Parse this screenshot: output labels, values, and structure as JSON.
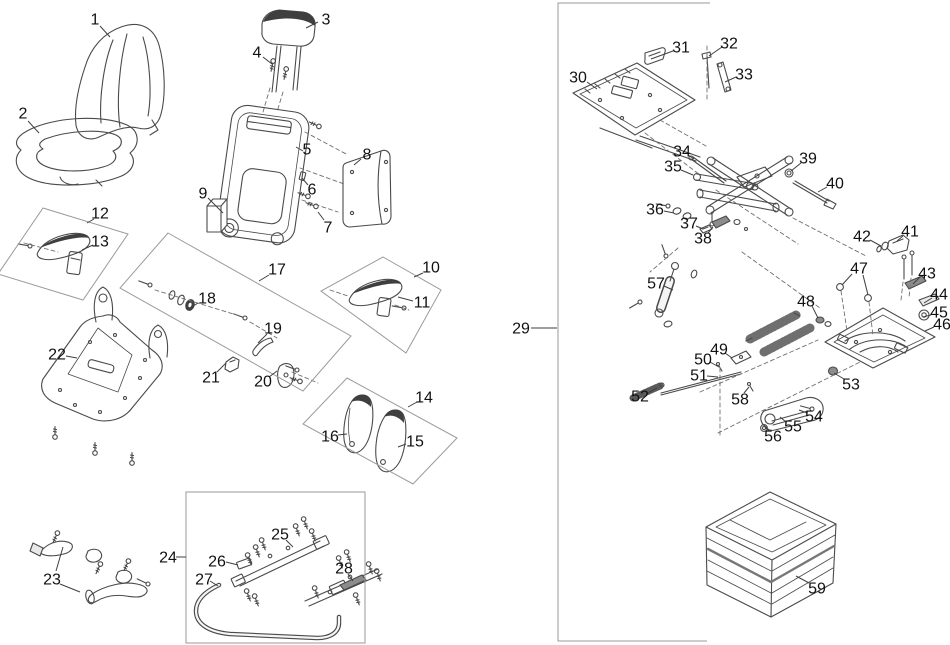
{
  "diagram": {
    "type": "exploded-parts-diagram",
    "subject": "operator seat assembly with suspension",
    "background": "#ffffff",
    "line_color": "#4a4a4a",
    "box_color": "#9a9a9a",
    "label_color": "#111111",
    "labels": [
      {
        "n": "1",
        "x": 95,
        "y": 19,
        "leaders": [
          [
            100,
            26,
            110,
            37
          ]
        ]
      },
      {
        "n": "2",
        "x": 23,
        "y": 113,
        "leaders": [
          [
            28,
            121,
            39,
            133
          ]
        ]
      },
      {
        "n": "3",
        "x": 326,
        "y": 19,
        "leaders": [
          [
            318,
            22,
            306,
            28
          ]
        ]
      },
      {
        "n": "4",
        "x": 257,
        "y": 52,
        "leaders": [
          [
            263,
            57,
            272,
            64
          ]
        ]
      },
      {
        "n": "5",
        "x": 307,
        "y": 149,
        "leaders": [
          [
            303,
            151,
            296,
            147
          ]
        ]
      },
      {
        "n": "6",
        "x": 312,
        "y": 189,
        "leaders": [
          [
            308,
            185,
            302,
            178
          ]
        ]
      },
      {
        "n": "7",
        "x": 328,
        "y": 227,
        "leaders": [
          [
            324,
            220,
            318,
            212
          ]
        ]
      },
      {
        "n": "8",
        "x": 367,
        "y": 154,
        "leaders": [
          [
            361,
            159,
            354,
            165
          ]
        ]
      },
      {
        "n": "9",
        "x": 203,
        "y": 193,
        "leaders": [
          [
            208,
            198,
            223,
            213
          ]
        ]
      },
      {
        "n": "10",
        "x": 431,
        "y": 267,
        "leaders": [
          [
            423,
            273,
            414,
            277
          ]
        ]
      },
      {
        "n": "11",
        "x": 422,
        "y": 302,
        "leaders": [
          [
            413,
            301,
            398,
            297
          ]
        ]
      },
      {
        "n": "12",
        "x": 100,
        "y": 213,
        "leaders": [
          [
            94,
            219,
            87,
            223
          ]
        ]
      },
      {
        "n": "13",
        "x": 100,
        "y": 241,
        "leaders": [
          [
            93,
            245,
            82,
            250
          ]
        ]
      },
      {
        "n": "14",
        "x": 424,
        "y": 397,
        "leaders": [
          [
            417,
            402,
            408,
            407
          ]
        ]
      },
      {
        "n": "15",
        "x": 415,
        "y": 441,
        "leaders": [
          [
            406,
            444,
            398,
            447
          ]
        ]
      },
      {
        "n": "16",
        "x": 330,
        "y": 436,
        "leaders": [
          [
            338,
            435,
            347,
            434
          ]
        ]
      },
      {
        "n": "17",
        "x": 277,
        "y": 269,
        "leaders": [
          [
            269,
            275,
            259,
            281
          ]
        ]
      },
      {
        "n": "18",
        "x": 207,
        "y": 298,
        "leaders": [
          [
            198,
            303,
            190,
            308
          ]
        ]
      },
      {
        "n": "19",
        "x": 273,
        "y": 328,
        "leaders": [
          [
            267,
            334,
            258,
            343
          ]
        ]
      },
      {
        "n": "20",
        "x": 263,
        "y": 381,
        "leaders": [
          [
            269,
            377,
            277,
            371
          ]
        ]
      },
      {
        "n": "21",
        "x": 211,
        "y": 377,
        "leaders": [
          [
            217,
            372,
            226,
            363
          ]
        ]
      },
      {
        "n": "22",
        "x": 57,
        "y": 354,
        "leaders": [
          [
            66,
            356,
            77,
            358
          ]
        ]
      },
      {
        "n": "23",
        "x": 52,
        "y": 579,
        "leaders": [
          [
            56,
            571,
            63,
            547
          ],
          [
            60,
            584,
            80,
            592
          ]
        ]
      },
      {
        "n": "24",
        "x": 168,
        "y": 557,
        "leaders": [
          [
            176,
            557,
            186,
            557
          ]
        ]
      },
      {
        "n": "25",
        "x": 280,
        "y": 534,
        "leaders": [
          [
            286,
            540,
            293,
            547
          ]
        ]
      },
      {
        "n": "26",
        "x": 217,
        "y": 561,
        "leaders": [
          [
            226,
            562,
            238,
            565
          ]
        ]
      },
      {
        "n": "27",
        "x": 204,
        "y": 579,
        "leaders": [
          [
            210,
            581,
            218,
            586
          ]
        ]
      },
      {
        "n": "28",
        "x": 344,
        "y": 568,
        "leaders": [
          [
            348,
            574,
            353,
            581
          ]
        ]
      },
      {
        "n": "29",
        "x": 521,
        "y": 328,
        "leaders": [
          [
            531,
            328,
            557,
            328
          ]
        ]
      },
      {
        "n": "30",
        "x": 578,
        "y": 77,
        "leaders": [
          [
            587,
            82,
            597,
            89
          ]
        ]
      },
      {
        "n": "31",
        "x": 681,
        "y": 47,
        "leaders": [
          [
            673,
            51,
            651,
            59
          ]
        ]
      },
      {
        "n": "32",
        "x": 729,
        "y": 43,
        "leaders": [
          [
            722,
            47,
            709,
            56
          ]
        ]
      },
      {
        "n": "33",
        "x": 744,
        "y": 74,
        "leaders": [
          [
            736,
            77,
            725,
            82
          ]
        ]
      },
      {
        "n": "34",
        "x": 682,
        "y": 151,
        "leaders": [
          [
            688,
            155,
            694,
            159
          ]
        ]
      },
      {
        "n": "35",
        "x": 673,
        "y": 166,
        "leaders": [
          [
            681,
            170,
            693,
            175
          ]
        ]
      },
      {
        "n": "36",
        "x": 655,
        "y": 209,
        "leaders": [
          [
            664,
            211,
            674,
            213
          ]
        ]
      },
      {
        "n": "37",
        "x": 689,
        "y": 223,
        "leaders": [
          [
            696,
            226,
            703,
            229
          ]
        ]
      },
      {
        "n": "38",
        "x": 703,
        "y": 238,
        "leaders": [
          [
            708,
            233,
            713,
            227
          ]
        ]
      },
      {
        "n": "39",
        "x": 808,
        "y": 158,
        "leaders": [
          [
            801,
            163,
            791,
            171
          ]
        ]
      },
      {
        "n": "40",
        "x": 835,
        "y": 183,
        "leaders": [
          [
            827,
            187,
            818,
            192
          ]
        ]
      },
      {
        "n": "41",
        "x": 910,
        "y": 231,
        "leaders": [
          [
            903,
            236,
            897,
            241
          ]
        ]
      },
      {
        "n": "42",
        "x": 862,
        "y": 236,
        "leaders": [
          [
            870,
            240,
            881,
            246
          ]
        ]
      },
      {
        "n": "43",
        "x": 927,
        "y": 273,
        "leaders": [
          [
            920,
            277,
            913,
            284
          ]
        ]
      },
      {
        "n": "44",
        "x": 939,
        "y": 294,
        "leaders": [
          [
            932,
            298,
            924,
            303
          ]
        ]
      },
      {
        "n": "45",
        "x": 939,
        "y": 312,
        "leaders": [
          [
            931,
            315,
            923,
            317
          ]
        ]
      },
      {
        "n": "46",
        "x": 942,
        "y": 324,
        "leaders": [
          [
            934,
            327,
            925,
            331
          ]
        ]
      },
      {
        "n": "47",
        "x": 859,
        "y": 268,
        "leaders": [
          [
            852,
            274,
            842,
            285
          ],
          [
            863,
            275,
            868,
            295
          ]
        ]
      },
      {
        "n": "48",
        "x": 806,
        "y": 301,
        "leaders": [
          [
            812,
            306,
            818,
            318
          ]
        ]
      },
      {
        "n": "49",
        "x": 719,
        "y": 349,
        "leaders": [
          [
            725,
            353,
            732,
            358
          ]
        ]
      },
      {
        "n": "50",
        "x": 703,
        "y": 359,
        "leaders": [
          [
            710,
            362,
            719,
            367
          ]
        ]
      },
      {
        "n": "51",
        "x": 699,
        "y": 375,
        "leaders": [
          [
            707,
            376,
            718,
            377
          ]
        ]
      },
      {
        "n": "52",
        "x": 640,
        "y": 396,
        "leaders": [
          [
            648,
            393,
            657,
            388
          ]
        ]
      },
      {
        "n": "53",
        "x": 851,
        "y": 384,
        "leaders": [
          [
            844,
            379,
            834,
            373
          ]
        ]
      },
      {
        "n": "54",
        "x": 814,
        "y": 416,
        "leaders": [
          [
            807,
            413,
            799,
            410
          ]
        ]
      },
      {
        "n": "55",
        "x": 793,
        "y": 426,
        "leaders": [
          [
            786,
            422,
            780,
            417
          ]
        ]
      },
      {
        "n": "56",
        "x": 773,
        "y": 436,
        "leaders": [
          [
            769,
            431,
            765,
            427
          ]
        ]
      },
      {
        "n": "57",
        "x": 656,
        "y": 283,
        "leaders": [
          [
            664,
            286,
            673,
            290
          ]
        ]
      },
      {
        "n": "58",
        "x": 740,
        "y": 399,
        "leaders": [
          [
            744,
            393,
            749,
            387
          ]
        ]
      },
      {
        "n": "59",
        "x": 817,
        "y": 588,
        "leaders": [
          [
            809,
            583,
            796,
            576
          ]
        ]
      }
    ],
    "groups": [
      {
        "id": "12",
        "closed": true,
        "points": [
          [
            43,
            208
          ],
          [
            128,
            234
          ],
          [
            83,
            300
          ],
          [
            -2,
            274
          ]
        ]
      },
      {
        "id": "17",
        "closed": true,
        "points": [
          [
            168,
            233
          ],
          [
            351,
            336
          ],
          [
            303,
            391
          ],
          [
            120,
            288
          ]
        ]
      },
      {
        "id": "10",
        "closed": true,
        "points": [
          [
            383,
            257
          ],
          [
            441,
            290
          ],
          [
            406,
            353
          ],
          [
            321,
            291
          ]
        ]
      },
      {
        "id": "14",
        "closed": true,
        "points": [
          [
            347,
            378
          ],
          [
            457,
            438
          ],
          [
            413,
            484
          ],
          [
            303,
            424
          ]
        ]
      },
      {
        "id": "24",
        "closed": true,
        "points": [
          [
            186,
            492
          ],
          [
            365,
            492
          ],
          [
            365,
            643
          ],
          [
            186,
            643
          ]
        ]
      },
      {
        "id": "29",
        "closed": false,
        "points": [
          [
            710,
            3
          ],
          [
            558,
            3
          ],
          [
            558,
            641
          ],
          [
            707,
            641
          ]
        ]
      }
    ]
  }
}
